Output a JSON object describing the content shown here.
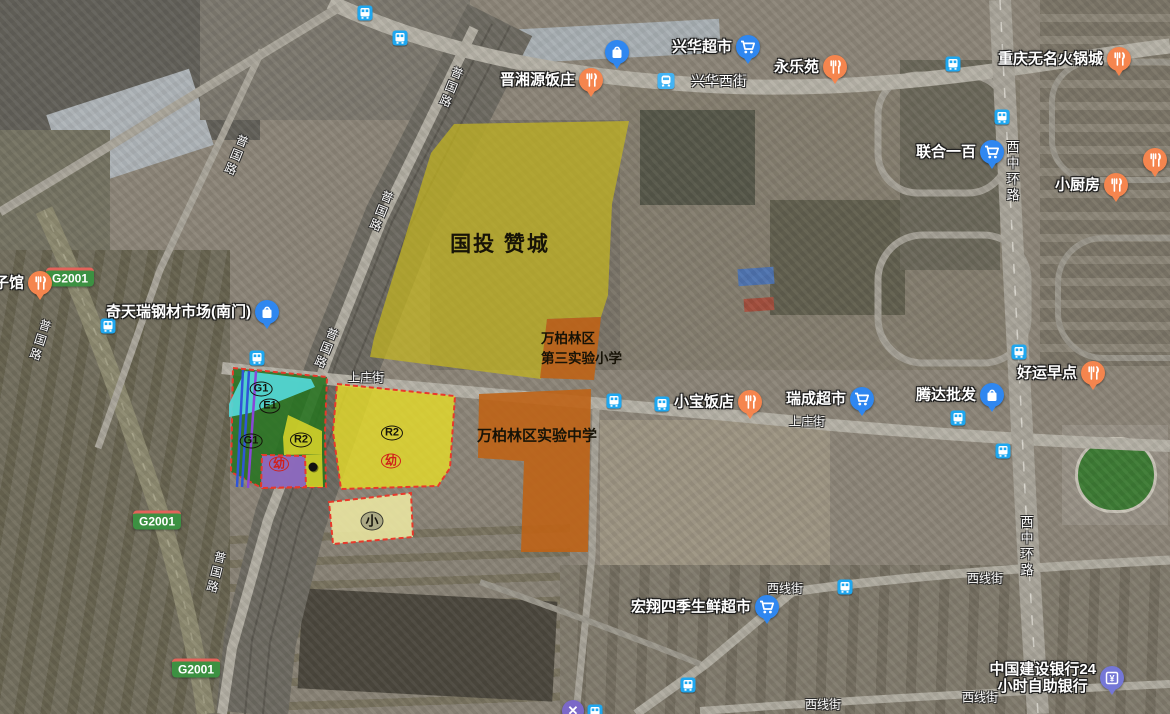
{
  "title": "satellite-planning-map",
  "colors": {
    "pin_restaurant": "#f5854e",
    "pin_shopping": "#2f87f0",
    "pin_bank": "#7577d6",
    "pin_partial_x": "#7b68c8",
    "bus_icon": "#1ea7f0",
    "metro_icon": "#42b3f4",
    "zone_border_red": "#e8392b",
    "zone_yellow_big": "rgba(197,181,30,0.72)",
    "zone_orange": "rgba(191,99,22,0.90)",
    "zone_yellow_r2": "rgba(228,218,42,0.82)",
    "zone_yellow_pale": "rgba(236,231,162,0.88)",
    "zone_green": "rgba(39,115,32,0.88)",
    "zone_cyan": "rgba(84,216,216,0.92)",
    "zone_purple": "rgba(148,104,200,0.92)",
    "badge_green": "#3c9142"
  },
  "pois": [
    {
      "label": "晋湘源饭庄",
      "pin": "restaurant",
      "x": 591,
      "y": 80
    },
    {
      "label": "兴华超市",
      "pin": "cart",
      "x": 748,
      "y": 47
    },
    {
      "label": "永乐苑",
      "pin": "restaurant",
      "x": 835,
      "y": 67
    },
    {
      "label": "重庆无名火锅城",
      "pin": "restaurant",
      "x": 1119,
      "y": 59
    },
    {
      "label": "联合一百",
      "pin": "cart",
      "x": 992,
      "y": 152
    },
    {
      "label": "小厨房",
      "pin": "restaurant",
      "x": 1116,
      "y": 185
    },
    {
      "label": "",
      "pin": "restaurant",
      "x": 1155,
      "y": 160
    },
    {
      "label": "子馆",
      "pin": "restaurant",
      "x": 40,
      "y": 283
    },
    {
      "label": "奇天瑞钢材市场(南门)",
      "pin": "bag",
      "x": 267,
      "y": 312
    },
    {
      "label": "",
      "pin": "bag",
      "x": 617,
      "y": 52
    },
    {
      "label": "小宝饭店",
      "pin": "restaurant",
      "x": 750,
      "y": 402
    },
    {
      "label": "瑞成超市",
      "pin": "cart",
      "x": 862,
      "y": 399
    },
    {
      "label": "腾达批发",
      "pin": "bag",
      "x": 992,
      "y": 395
    },
    {
      "label": "好运早点",
      "pin": "restaurant",
      "x": 1093,
      "y": 373
    },
    {
      "label": "宏翔四季生鲜超市",
      "pin": "cart",
      "x": 767,
      "y": 607
    },
    {
      "label": "中国建设银行24\n小时自助银行",
      "pin": "bank",
      "x": 1112,
      "y": 678
    }
  ],
  "road_labels": [
    {
      "text": "兴华西街",
      "x": 719,
      "y": 81,
      "size": 14
    },
    {
      "text": "上庄街",
      "x": 366,
      "y": 377,
      "size": 12
    },
    {
      "text": "上庄街",
      "x": 807,
      "y": 421,
      "size": 12
    },
    {
      "text": "西线街",
      "x": 785,
      "y": 588,
      "size": 12
    },
    {
      "text": "西线街",
      "x": 985,
      "y": 578,
      "size": 12
    },
    {
      "text": "西线街",
      "x": 823,
      "y": 704,
      "size": 12
    },
    {
      "text": "西线街",
      "x": 980,
      "y": 697,
      "size": 12
    },
    {
      "text": "西中环路",
      "x": 1012,
      "y": 172,
      "size": 13,
      "vert": true
    },
    {
      "text": "西中环路",
      "x": 1026,
      "y": 547,
      "size": 13,
      "vert": true
    },
    {
      "text": "普国路",
      "x": 236,
      "y": 156,
      "size": 12,
      "vert": true,
      "rot": 22
    },
    {
      "text": "普国路",
      "x": 381,
      "y": 212,
      "size": 12,
      "vert": true,
      "rot": 22
    },
    {
      "text": "普国路",
      "x": 326,
      "y": 349,
      "size": 12,
      "vert": true,
      "rot": 22
    },
    {
      "text": "普国路",
      "x": 451,
      "y": 88,
      "size": 12,
      "vert": true,
      "rot": 22
    },
    {
      "text": "普国路",
      "x": 40,
      "y": 341,
      "size": 12,
      "vert": true,
      "rot": 18
    },
    {
      "text": "普国路",
      "x": 216,
      "y": 573,
      "size": 12,
      "vert": true,
      "rot": 14
    }
  ],
  "highway_badges": [
    {
      "text": "G2001",
      "x": 70,
      "y": 277
    },
    {
      "text": "G2001",
      "x": 157,
      "y": 520
    },
    {
      "text": "G2001",
      "x": 196,
      "y": 668
    }
  ],
  "transit": {
    "bus_stops": [
      [
        365,
        13
      ],
      [
        400,
        38
      ],
      [
        953,
        64
      ],
      [
        1002,
        117
      ],
      [
        108,
        326
      ],
      [
        257,
        358
      ],
      [
        1019,
        352
      ],
      [
        614,
        401
      ],
      [
        662,
        404
      ],
      [
        958,
        418
      ],
      [
        1003,
        451
      ],
      [
        845,
        587
      ],
      [
        688,
        685
      ],
      [
        595,
        712
      ]
    ],
    "metro_stops": [
      [
        666,
        81
      ]
    ],
    "partial_x_pin": [
      [
        573,
        711
      ]
    ]
  },
  "zones": [
    {
      "name": "guotou-zancheng",
      "fillKey": "zone_yellow_big",
      "stroke": "none",
      "points": "454,124 629,121 612,204 608,295 601,317 547,319 541,379 370,357 374,338 431,153"
    },
    {
      "name": "disan-shiyan-xiaoxue",
      "fillKey": "zone_orange",
      "stroke": "none",
      "points": "547,319 601,317 594,380 540,378"
    },
    {
      "name": "shiyan-zhongxue",
      "fillKey": "zone_orange",
      "stroke": "none",
      "points": "479,394 591,389 588,552 521,552 524,461 478,458"
    },
    {
      "name": "parcel-green-g1",
      "fillKey": "zone_green",
      "stroke": "red-dash",
      "points": "233,368 327,377 325,432 326,487 262,488 231,472"
    },
    {
      "name": "parcel-cyan-e1",
      "fillKey": "zone_cyan",
      "stroke": "none",
      "points": "245,371 311,379 315,387 250,413 229,417 229,404"
    },
    {
      "name": "parcel-yellow-r2a",
      "fillKey": "zone_yellow_r2",
      "stroke": "none",
      "points": "288,415 322,431 322,454 284,455 283,437"
    },
    {
      "name": "parcel-yellow-r2b",
      "fillKey": "zone_yellow_r2",
      "stroke": "none",
      "points": "305,455 322,454 323,487 306,487"
    },
    {
      "name": "parcel-purple",
      "fillKey": "zone_purple",
      "stroke": "red-dash",
      "points": "262,455 305,456 306,487 261,488"
    },
    {
      "name": "parcel-r2-mid",
      "fillKey": "zone_yellow_r2",
      "stroke": "red-dash",
      "points": "337,384 455,396 450,468 438,486 341,489 333,432"
    },
    {
      "name": "parcel-xiao",
      "fillKey": "zone_yellow_pale",
      "stroke": "red-dash",
      "points": "329,502 411,493 413,537 333,544"
    }
  ],
  "zone_lines": [
    {
      "color": "#2f55d8",
      "points": "243,370 237,487"
    },
    {
      "color": "#2f55d8",
      "points": "249,371 242,487"
    },
    {
      "color": "#8a45d8",
      "points": "256,371 248,488"
    }
  ],
  "zone_labels": [
    {
      "text": "G1",
      "x": 261,
      "y": 389,
      "style": "pill"
    },
    {
      "text": "E1",
      "x": 270,
      "y": 406,
      "style": "pill"
    },
    {
      "text": "G1",
      "x": 251,
      "y": 441,
      "style": "pill"
    },
    {
      "text": "R2",
      "x": 301,
      "y": 440,
      "style": "pill"
    },
    {
      "text": "R2",
      "x": 392,
      "y": 433,
      "style": "pill"
    },
    {
      "text": "幼",
      "x": 279,
      "y": 464,
      "style": "red"
    },
    {
      "text": "幼",
      "x": 391,
      "y": 461,
      "style": "red"
    },
    {
      "text": "小",
      "x": 372,
      "y": 521,
      "style": "dark"
    }
  ],
  "overlay_labels": [
    {
      "text": "国投 赞城",
      "x": 500,
      "y": 243,
      "size": 21,
      "align": "center",
      "ls": 2
    },
    {
      "text": "万柏林区\n第三实验小学",
      "x": 541,
      "y": 327,
      "size": 13.5,
      "align": "left"
    },
    {
      "text": "万柏林区实验中学",
      "x": 537,
      "y": 435,
      "size": 15,
      "align": "center"
    }
  ],
  "dot_markers": [
    [
      313,
      467
    ]
  ]
}
